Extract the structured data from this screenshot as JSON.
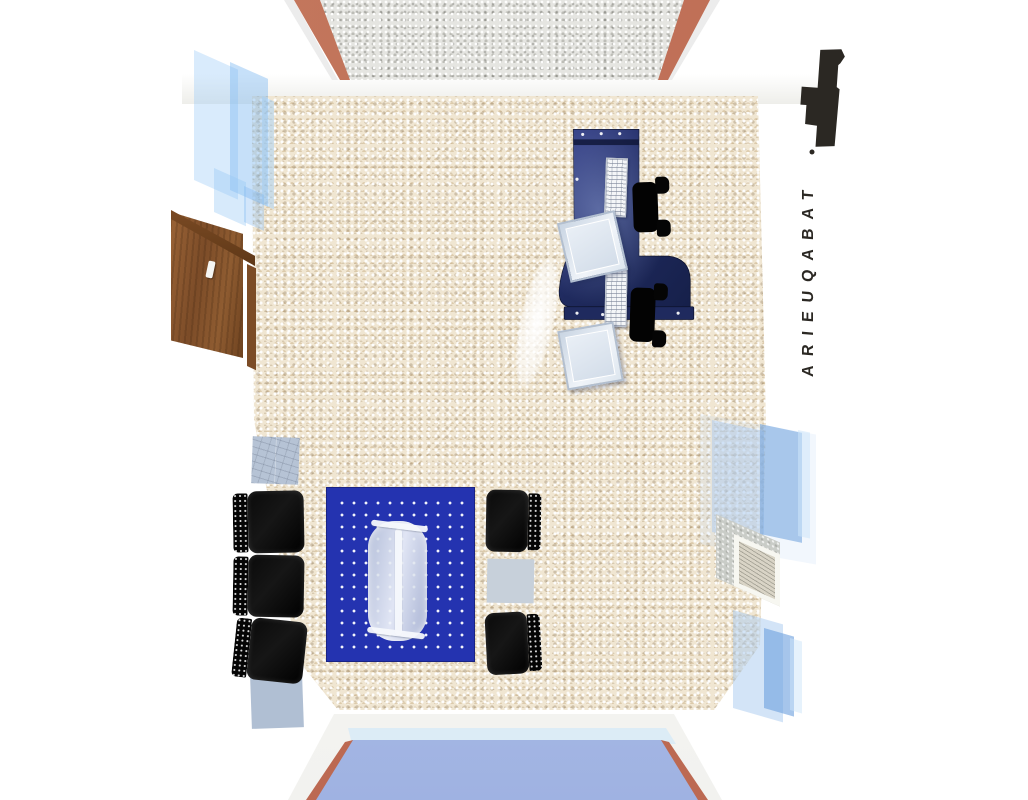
{
  "scene": {
    "description": "3D top-down architectural render of a tobacconist shop interior",
    "sign": {
      "text": "TABAQUEIRA",
      "logo": "tabaqueira-logo-mark"
    },
    "colors": {
      "desk_navy": "#1f2a5e",
      "desk_navy_dark": "#10173a",
      "desk_navy_light": "#36418a",
      "rug_blue": "#2433b0",
      "floor_base": "#f0e6d2",
      "backwall_base": "#e5e5e1",
      "terracotta": "#bc6952",
      "glass_blue": "#9fb2e2",
      "glass_pale": "#cdd9ef",
      "wood_mid": "#7c4c28",
      "wood_dark": "#5f3817",
      "chair_black": "#0a0a0a",
      "sign_black": "#2b2823",
      "monitor_face": "#e9eff6",
      "table_glass": "#cfd8e4",
      "corner_grey": "#a8a8a8"
    },
    "objects": {
      "entry_door": "wooden door on left wall",
      "reception_desk": "curved navy reception desk",
      "desk_monitors": 2,
      "desk_keyboards": 2,
      "desk_chairs": 2,
      "lounge_chairs_left": 3,
      "lounge_chairs_right": 2,
      "rug": "blue dotted lounge rug",
      "coffee_table": "frosted glass table",
      "display_cases": 3,
      "wall_picture_frame": 1,
      "window_wall": "glass storefront at bottom"
    }
  }
}
